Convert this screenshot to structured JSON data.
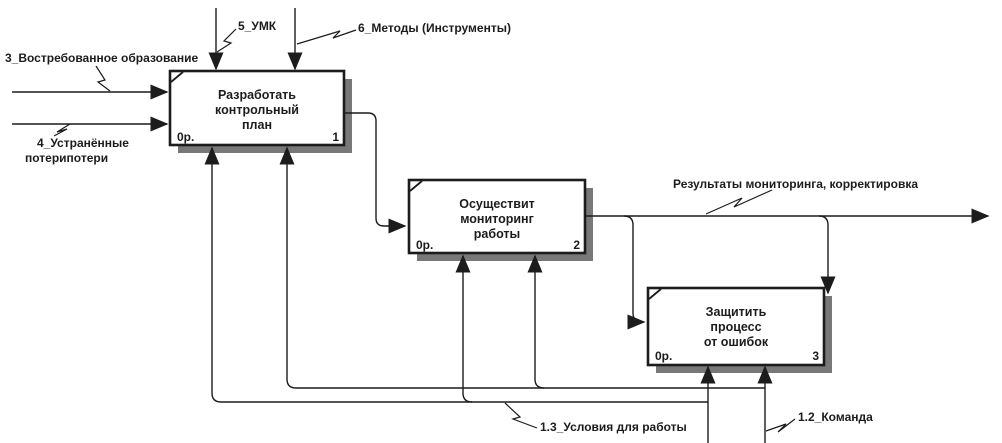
{
  "diagram": {
    "type": "IDEF0",
    "activities": [
      {
        "name_lines": [
          "Разработать",
          "контрольный",
          "план"
        ],
        "cost": "0р.",
        "number": "1"
      },
      {
        "name_lines": [
          "Осуществит",
          "мониторинг",
          "работы"
        ],
        "cost": "0р.",
        "number": "2"
      },
      {
        "name_lines": [
          "Защитить",
          "процесс",
          "от ошибок"
        ],
        "cost": "0р.",
        "number": "3"
      }
    ],
    "arrows": {
      "input_1": "3_Востребованное образование",
      "input_2_line_1": "4_Устранённые",
      "input_2_line_2": "потерипотери",
      "control_1": "5_УМК",
      "control_2": "6_Методы (Инструменты)",
      "output_1": "Результаты мониторинга, корректировка",
      "mechanism_1": "1.3_Условия для работы",
      "mechanism_2": "1.2_Команда"
    },
    "colors": {
      "line": "#1c1c1c",
      "shadow": "#787878",
      "box_fill": "#ffffff",
      "background": "#ffffff"
    }
  }
}
